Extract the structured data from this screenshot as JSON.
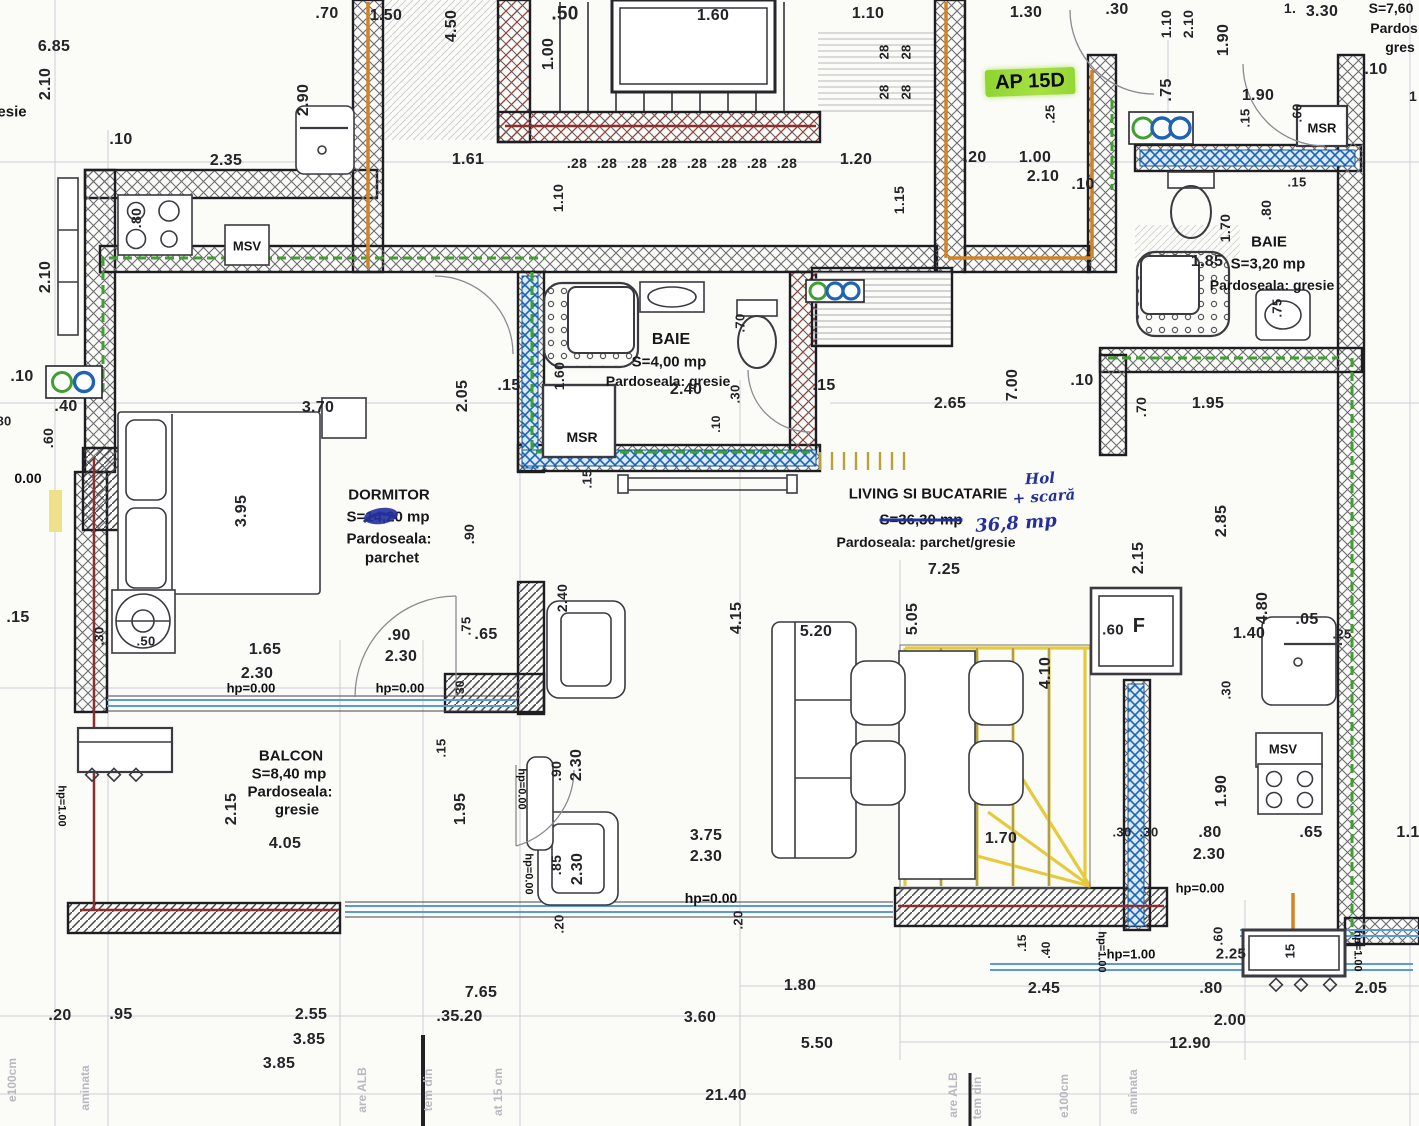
{
  "apartment_tag": "AP 15D",
  "rooms": [
    {
      "name": "DORMITOR",
      "area": "S=14,20 mp",
      "floor": "Pardoseala: parchet"
    },
    {
      "name": "BAIE",
      "area": "S=4,00 mp",
      "floor": "Pardoseala: gresie"
    },
    {
      "name": "BAIE",
      "area": "S=3,20 mp",
      "floor": "Pardoseala: gresie"
    },
    {
      "name": "LIVING SI BUCATARIE",
      "area": "S=36,30 mp",
      "area_handwritten": "36,8 mp",
      "floor": "Pardoseala: parchet/gresie",
      "handwritten_note": "Hol + scară"
    },
    {
      "name": "BALCON",
      "area": "S=8,40 mp",
      "floor": "Pardoseala: gresie"
    },
    {
      "name": "",
      "area": "S=7,60",
      "floor": "Pardos gres"
    }
  ],
  "markers": [
    "MSV",
    "MSR"
  ],
  "levels": [
    "hp=0.00",
    "hp=1.00"
  ],
  "colors": {
    "highlight": "#8fd431",
    "ink_blue": "#23309c",
    "pipe_green": "#3f9f2f",
    "pipe_blue": "#1e63b4",
    "pipe_orange": "#d08428",
    "pipe_red": "#8a2f2f",
    "stair_yellow": "#e6c832"
  },
  "labels": [
    {
      "t": ".70",
      "x": 327,
      "y": 14
    },
    {
      "t": "1.50",
      "x": 386,
      "y": 16
    },
    {
      "t": "4.50",
      "x": 452,
      "y": 26,
      "r": -90
    },
    {
      "t": ".50",
      "x": 565,
      "y": 14,
      "s": 19
    },
    {
      "t": "1.00",
      "x": 549,
      "y": 54,
      "r": -90
    },
    {
      "t": "1.60",
      "x": 713,
      "y": 16
    },
    {
      "t": "1.10",
      "x": 868,
      "y": 14
    },
    {
      "t": "28",
      "x": 884,
      "y": 52,
      "r": -90,
      "s": 13
    },
    {
      "t": "28",
      "x": 884,
      "y": 92,
      "r": -90,
      "s": 13
    },
    {
      "t": "28",
      "x": 906,
      "y": 52,
      "r": -90,
      "s": 13
    },
    {
      "t": "28",
      "x": 906,
      "y": 92,
      "r": -90,
      "s": 13
    },
    {
      "t": "1.30",
      "x": 1026,
      "y": 13
    },
    {
      "t": ".30",
      "x": 1117,
      "y": 10
    },
    {
      "t": "1.10",
      "x": 1166,
      "y": 24,
      "r": -90,
      "s": 14
    },
    {
      "t": "2.10",
      "x": 1188,
      "y": 24,
      "r": -90,
      "s": 14
    },
    {
      "t": "1.90",
      "x": 1224,
      "y": 40,
      "r": -90
    },
    {
      "t": "1.",
      "x": 1290,
      "y": 8,
      "s": 14
    },
    {
      "t": "3.30",
      "x": 1322,
      "y": 12
    },
    {
      "t": "S=7,60",
      "x": 1391,
      "y": 8,
      "s": 14,
      "k": "room"
    },
    {
      "t": "Pardos",
      "x": 1394,
      "y": 28,
      "s": 14,
      "k": "room"
    },
    {
      "t": "gres",
      "x": 1400,
      "y": 47,
      "s": 14,
      "k": "room"
    },
    {
      "t": ".10",
      "x": 1376,
      "y": 70
    },
    {
      "t": "1",
      "x": 1413,
      "y": 96,
      "s": 14
    },
    {
      "t": "AP 15D",
      "x": 1030,
      "y": 82,
      "r": -2,
      "s": 20,
      "k": "ap"
    },
    {
      "t": ".25",
      "x": 1050,
      "y": 114,
      "r": -90,
      "s": 13
    },
    {
      "t": ".75",
      "x": 1167,
      "y": 90,
      "r": -90
    },
    {
      "t": "1.90",
      "x": 1258,
      "y": 96
    },
    {
      "t": ".15",
      "x": 1245,
      "y": 118,
      "r": -90,
      "s": 13
    },
    {
      "t": ".60",
      "x": 1297,
      "y": 113,
      "r": -90,
      "s": 13
    },
    {
      "t": "MSR",
      "x": 1322,
      "y": 128,
      "s": 13,
      "k": "room"
    },
    {
      "t": "6.85",
      "x": 54,
      "y": 47
    },
    {
      "t": "2.10",
      "x": 46,
      "y": 84,
      "r": -90
    },
    {
      "t": "esie",
      "x": 12,
      "y": 112,
      "s": 15,
      "k": "room"
    },
    {
      "t": ".10",
      "x": 121,
      "y": 140
    },
    {
      "t": "2.35",
      "x": 226,
      "y": 161
    },
    {
      "t": "2.90",
      "x": 304,
      "y": 100,
      "r": -90
    },
    {
      "t": ".80",
      "x": 136,
      "y": 218,
      "r": -90,
      "s": 14
    },
    {
      "t": "MSV",
      "x": 247,
      "y": 246,
      "s": 13,
      "k": "room"
    },
    {
      "t": "1.61",
      "x": 468,
      "y": 160
    },
    {
      "t": ".28",
      "x": 577,
      "y": 163,
      "s": 14
    },
    {
      "t": ".28",
      "x": 607,
      "y": 163,
      "s": 14
    },
    {
      "t": ".28",
      "x": 637,
      "y": 163,
      "s": 14
    },
    {
      "t": ".28",
      "x": 667,
      "y": 163,
      "s": 14
    },
    {
      "t": ".28",
      "x": 697,
      "y": 163,
      "s": 14
    },
    {
      "t": ".28",
      "x": 727,
      "y": 163,
      "s": 14
    },
    {
      "t": ".28",
      "x": 757,
      "y": 163,
      "s": 14
    },
    {
      "t": ".28",
      "x": 787,
      "y": 163,
      "s": 14
    },
    {
      "t": "1.20",
      "x": 856,
      "y": 160
    },
    {
      "t": "1.15",
      "x": 899,
      "y": 200,
      "r": -90,
      "s": 14
    },
    {
      "t": "1.10",
      "x": 558,
      "y": 198,
      "r": -90,
      "s": 14
    },
    {
      "t": ".20",
      "x": 975,
      "y": 158
    },
    {
      "t": "1.00",
      "x": 1035,
      "y": 158
    },
    {
      "t": "2.10",
      "x": 1043,
      "y": 177
    },
    {
      "t": ".10",
      "x": 1083,
      "y": 185
    },
    {
      "t": "2.10",
      "x": 46,
      "y": 277,
      "r": -90
    },
    {
      "t": "BAIE",
      "x": 1269,
      "y": 242,
      "s": 15,
      "k": "room"
    },
    {
      "t": "1.85",
      "x": 1207,
      "y": 262
    },
    {
      "t": "S=3,20 mp",
      "x": 1268,
      "y": 264,
      "s": 15,
      "k": "room"
    },
    {
      "t": "Pardoseala: gresie",
      "x": 1272,
      "y": 285,
      "s": 14,
      "k": "room"
    },
    {
      "t": "1.70",
      "x": 1225,
      "y": 228,
      "r": -90,
      "s": 14
    },
    {
      "t": ".80",
      "x": 1266,
      "y": 210,
      "r": -90,
      "s": 14
    },
    {
      "t": ".75",
      "x": 1277,
      "y": 308,
      "r": -90,
      "s": 13
    },
    {
      "t": ".15",
      "x": 1297,
      "y": 182,
      "s": 13
    },
    {
      "t": ".10",
      "x": 22,
      "y": 377
    },
    {
      "t": ".40",
      "x": 66,
      "y": 407
    },
    {
      "t": "80",
      "x": 4,
      "y": 421,
      "s": 13
    },
    {
      "t": ".60",
      "x": 48,
      "y": 438,
      "r": -90,
      "s": 14
    },
    {
      "t": "0.00",
      "x": 28,
      "y": 478,
      "s": 14,
      "k": "lvl"
    },
    {
      "t": "2.05",
      "x": 463,
      "y": 396,
      "r": -90
    },
    {
      "t": ".15",
      "x": 509,
      "y": 386
    },
    {
      "t": "1.60",
      "x": 559,
      "y": 376,
      "r": -90,
      "s": 14
    },
    {
      "t": "BAIE",
      "x": 671,
      "y": 340,
      "s": 16,
      "k": "room"
    },
    {
      "t": "S=4,00 mp",
      "x": 669,
      "y": 362,
      "s": 15,
      "k": "room"
    },
    {
      "t": "Pardoseala: gresie",
      "x": 668,
      "y": 381,
      "s": 14,
      "k": "room"
    },
    {
      "t": "2.40",
      "x": 686,
      "y": 390
    },
    {
      "t": ".70",
      "x": 740,
      "y": 323,
      "r": -90,
      "s": 13
    },
    {
      "t": ".30",
      "x": 735,
      "y": 394,
      "r": -90,
      "s": 13
    },
    {
      "t": ".10",
      "x": 716,
      "y": 424,
      "r": -90,
      "s": 12
    },
    {
      "t": ".15",
      "x": 824,
      "y": 386
    },
    {
      "t": "2.65",
      "x": 950,
      "y": 404
    },
    {
      "t": "7.00",
      "x": 1013,
      "y": 385,
      "r": -90
    },
    {
      "t": ".10",
      "x": 1082,
      "y": 381
    },
    {
      "t": ".70",
      "x": 1141,
      "y": 407,
      "r": -90,
      "s": 14
    },
    {
      "t": "1.95",
      "x": 1208,
      "y": 404
    },
    {
      "t": "MSR",
      "x": 582,
      "y": 437,
      "s": 14,
      "k": "room"
    },
    {
      "t": ".15",
      "x": 587,
      "y": 479,
      "r": -90,
      "s": 13
    },
    {
      "t": "3.70",
      "x": 318,
      "y": 408
    },
    {
      "t": "3.95",
      "x": 242,
      "y": 511,
      "r": -90
    },
    {
      "t": "DORMITOR",
      "x": 389,
      "y": 495,
      "s": 15,
      "k": "room"
    },
    {
      "t": "S=14,20 mp",
      "x": 388,
      "y": 517,
      "s": 15,
      "k": "room"
    },
    {
      "t": "Pardoseala:",
      "x": 389,
      "y": 539,
      "s": 15,
      "k": "room"
    },
    {
      "t": "parchet",
      "x": 392,
      "y": 558,
      "s": 15,
      "k": "room"
    },
    {
      "t": ".90",
      "x": 469,
      "y": 534,
      "r": -90,
      "s": 14
    },
    {
      "t": "LIVING SI BUCATARIE",
      "x": 928,
      "y": 494,
      "s": 15,
      "k": "room"
    },
    {
      "t": "S=36,30 mp",
      "x": 921,
      "y": 520,
      "s": 15,
      "k": "strike"
    },
    {
      "t": "36,8 mp",
      "x": 1016,
      "y": 524,
      "r": -4,
      "s": 18,
      "k": "hand"
    },
    {
      "t": "Hol",
      "x": 1040,
      "y": 479,
      "r": -3,
      "s": 15,
      "k": "hand"
    },
    {
      "t": "+ scară",
      "x": 1044,
      "y": 497,
      "r": -4,
      "s": 15,
      "k": "hand"
    },
    {
      "t": "Pardoseala: parchet/gresie",
      "x": 926,
      "y": 542,
      "s": 14,
      "k": "room"
    },
    {
      "t": "7.25",
      "x": 944,
      "y": 570
    },
    {
      "t": "2.15",
      "x": 1139,
      "y": 558,
      "r": -90
    },
    {
      "t": "2.85",
      "x": 1222,
      "y": 521,
      "r": -90
    },
    {
      "t": "5.05",
      "x": 913,
      "y": 619,
      "r": -90
    },
    {
      "t": "5.20",
      "x": 816,
      "y": 632
    },
    {
      "t": "4.15",
      "x": 737,
      "y": 618,
      "r": -90
    },
    {
      "t": "2.40",
      "x": 562,
      "y": 598,
      "r": -90,
      "s": 14
    },
    {
      "t": "4.10",
      "x": 1046,
      "y": 673,
      "r": -90
    },
    {
      "t": ".60",
      "x": 1113,
      "y": 630,
      "s": 15
    },
    {
      "t": "F",
      "x": 1139,
      "y": 626,
      "s": 20
    },
    {
      "t": "4.80",
      "x": 1263,
      "y": 608,
      "r": -90
    },
    {
      "t": ".05",
      "x": 1307,
      "y": 620
    },
    {
      "t": "1.40",
      "x": 1249,
      "y": 634
    },
    {
      "t": ".25",
      "x": 1342,
      "y": 634,
      "s": 13
    },
    {
      "t": ".15",
      "x": 18,
      "y": 618
    },
    {
      "t": ".30",
      "x": 99,
      "y": 636,
      "r": -90,
      "s": 13
    },
    {
      "t": ".50",
      "x": 146,
      "y": 641,
      "s": 13
    },
    {
      "t": "1.65",
      "x": 265,
      "y": 650
    },
    {
      "t": "2.30",
      "x": 257,
      "y": 674
    },
    {
      "t": ".90",
      "x": 399,
      "y": 636
    },
    {
      "t": "2.30",
      "x": 401,
      "y": 657
    },
    {
      "t": ".75",
      "x": 466,
      "y": 626,
      "r": -90,
      "s": 13
    },
    {
      "t": ".65",
      "x": 486,
      "y": 635
    },
    {
      "t": "hp=0.00",
      "x": 251,
      "y": 688,
      "s": 13,
      "k": "lvl"
    },
    {
      "t": "hp=0.00",
      "x": 400,
      "y": 688,
      "s": 13,
      "k": "lvl"
    },
    {
      "t": ".30",
      "x": 460,
      "y": 689,
      "r": -90,
      "s": 12
    },
    {
      "t": ".30",
      "x": 1226,
      "y": 690,
      "r": -90,
      "s": 13
    },
    {
      "t": "MSV",
      "x": 1283,
      "y": 749,
      "s": 13,
      "k": "room"
    },
    {
      "t": "1.90",
      "x": 1222,
      "y": 791,
      "r": -90
    },
    {
      "t": ".65",
      "x": 1311,
      "y": 833
    },
    {
      "t": "1.1",
      "x": 1408,
      "y": 833
    },
    {
      "t": ".30",
      "x": 1122,
      "y": 832,
      "s": 13
    },
    {
      "t": ".30",
      "x": 1149,
      "y": 832,
      "s": 13
    },
    {
      "t": ".80",
      "x": 1210,
      "y": 833
    },
    {
      "t": "2.30",
      "x": 1209,
      "y": 855
    },
    {
      "t": "1.70",
      "x": 1001,
      "y": 839
    },
    {
      "t": "BALCON",
      "x": 291,
      "y": 756,
      "s": 15,
      "k": "room"
    },
    {
      "t": "S=8,40 mp",
      "x": 289,
      "y": 774,
      "s": 15,
      "k": "room"
    },
    {
      "t": "Pardoseala:",
      "x": 290,
      "y": 792,
      "s": 15,
      "k": "room"
    },
    {
      "t": "gresie",
      "x": 297,
      "y": 810,
      "s": 15,
      "k": "room"
    },
    {
      "t": "2.15",
      "x": 232,
      "y": 809,
      "r": -90
    },
    {
      "t": "1.95",
      "x": 461,
      "y": 809,
      "r": -90
    },
    {
      "t": "4.05",
      "x": 285,
      "y": 844
    },
    {
      "t": ".15",
      "x": 441,
      "y": 748,
      "r": -90,
      "s": 13
    },
    {
      "t": "hp=1.00",
      "x": 61,
      "y": 806,
      "r": 90,
      "s": 11,
      "k": "lvl"
    },
    {
      "t": "hp=0.00",
      "x": 521,
      "y": 789,
      "r": 90,
      "s": 11,
      "k": "lvl"
    },
    {
      "t": "hp=0.00",
      "x": 528,
      "y": 874,
      "r": 90,
      "s": 11,
      "k": "lvl"
    },
    {
      "t": ".90",
      "x": 556,
      "y": 771,
      "r": -90,
      "s": 14
    },
    {
      "t": "2.30",
      "x": 577,
      "y": 765,
      "r": -90
    },
    {
      "t": ".85",
      "x": 556,
      "y": 865,
      "r": -90,
      "s": 14
    },
    {
      "t": "2.30",
      "x": 578,
      "y": 869,
      "r": -90
    },
    {
      "t": "3.75",
      "x": 706,
      "y": 836
    },
    {
      "t": "2.30",
      "x": 706,
      "y": 857
    },
    {
      "t": "hp=0.00",
      "x": 711,
      "y": 898,
      "s": 14,
      "k": "lvl"
    },
    {
      "t": ".20",
      "x": 559,
      "y": 924,
      "r": -90,
      "s": 13
    },
    {
      "t": ".20",
      "x": 738,
      "y": 920,
      "r": -90,
      "s": 13
    },
    {
      "t": "hp=0.00",
      "x": 1200,
      "y": 888,
      "s": 13,
      "k": "lvl"
    },
    {
      "t": ".15",
      "x": 1022,
      "y": 943,
      "r": -90,
      "s": 12
    },
    {
      "t": ".40",
      "x": 1046,
      "y": 950,
      "r": -90,
      "s": 12
    },
    {
      "t": "hp=1.00",
      "x": 1131,
      "y": 954,
      "s": 13,
      "k": "lvl"
    },
    {
      "t": "hp=1.00",
      "x": 1101,
      "y": 952,
      "r": 90,
      "s": 11,
      "k": "lvl"
    },
    {
      "t": "hp=1.00",
      "x": 1357,
      "y": 951,
      "r": 90,
      "s": 11,
      "k": "lvl"
    },
    {
      "t": ".60",
      "x": 1218,
      "y": 936,
      "r": -90,
      "s": 13
    },
    {
      "t": "2.25",
      "x": 1231,
      "y": 954,
      "s": 15
    },
    {
      "t": "15",
      "x": 1290,
      "y": 951,
      "r": -90,
      "s": 13
    },
    {
      "t": "1.80",
      "x": 800,
      "y": 986
    },
    {
      "t": "2.45",
      "x": 1044,
      "y": 989
    },
    {
      "t": ".80",
      "x": 1211,
      "y": 989
    },
    {
      "t": "2.05",
      "x": 1371,
      "y": 989
    },
    {
      "t": "2.00",
      "x": 1230,
      "y": 1021
    },
    {
      "t": "12.90",
      "x": 1190,
      "y": 1044
    },
    {
      "t": "7.65",
      "x": 481,
      "y": 993
    },
    {
      "t": ".35",
      "x": 448,
      "y": 1017
    },
    {
      "t": ".20",
      "x": 471,
      "y": 1017
    },
    {
      "t": ".20",
      "x": 60,
      "y": 1016
    },
    {
      "t": ".95",
      "x": 121,
      "y": 1015
    },
    {
      "t": "2.55",
      "x": 311,
      "y": 1015
    },
    {
      "t": "3.85",
      "x": 309,
      "y": 1040
    },
    {
      "t": "3.85",
      "x": 279,
      "y": 1064
    },
    {
      "t": "3.60",
      "x": 700,
      "y": 1018
    },
    {
      "t": "5.50",
      "x": 817,
      "y": 1044
    },
    {
      "t": "21.40",
      "x": 726,
      "y": 1096
    },
    {
      "t": "e100cm",
      "x": 12,
      "y": 1080,
      "r": -90,
      "s": 12,
      "k": "faint"
    },
    {
      "t": "aminata",
      "x": 85,
      "y": 1088,
      "r": -90,
      "s": 12,
      "k": "faint"
    },
    {
      "t": "are ALB",
      "x": 362,
      "y": 1090,
      "r": -90,
      "s": 12,
      "k": "faint"
    },
    {
      "t": "tem din",
      "x": 428,
      "y": 1090,
      "r": -90,
      "s": 12,
      "k": "faint"
    },
    {
      "t": "at 15 cm",
      "x": 498,
      "y": 1092,
      "r": -90,
      "s": 12,
      "k": "faint"
    },
    {
      "t": "are ALB",
      "x": 953,
      "y": 1095,
      "r": -90,
      "s": 12,
      "k": "faint"
    },
    {
      "t": "tem din",
      "x": 977,
      "y": 1098,
      "r": -90,
      "s": 12,
      "k": "faint"
    },
    {
      "t": "e100cm",
      "x": 1064,
      "y": 1096,
      "r": -90,
      "s": 12,
      "k": "faint"
    },
    {
      "t": "aminata",
      "x": 1133,
      "y": 1092,
      "r": -90,
      "s": 12,
      "k": "faint"
    }
  ]
}
